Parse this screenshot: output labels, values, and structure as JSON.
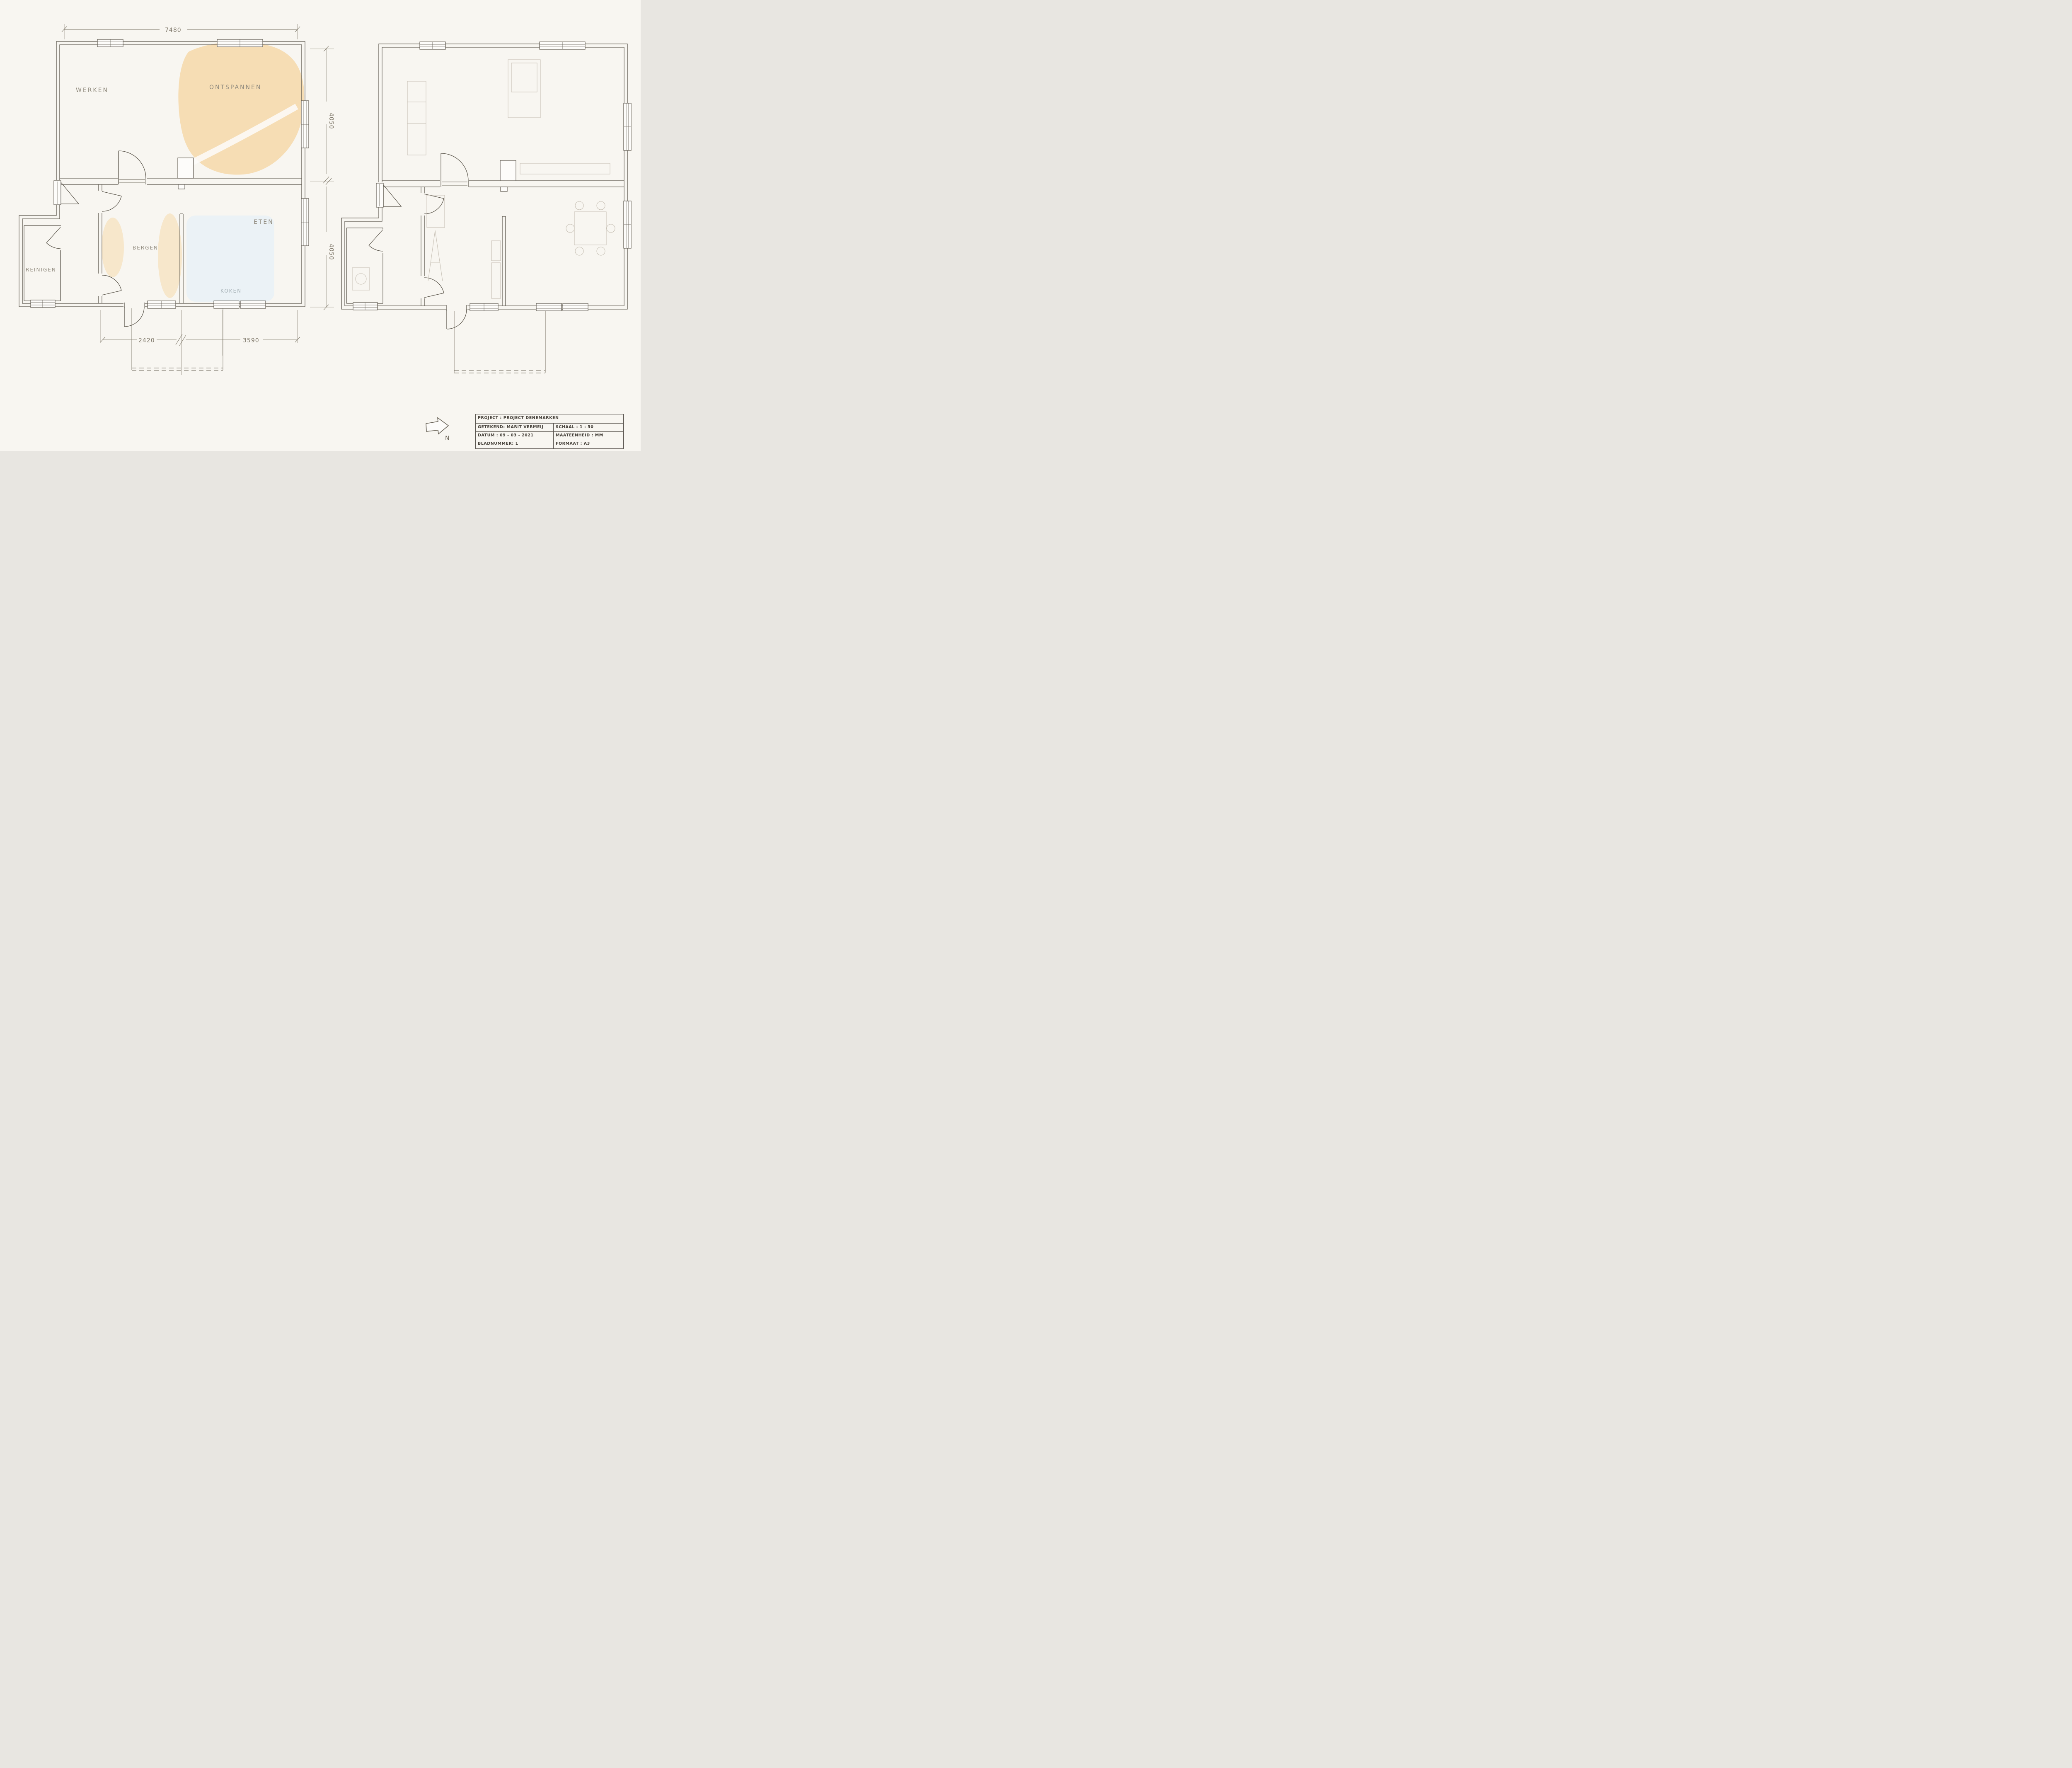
{
  "drawing": {
    "left_plan": {
      "rooms": {
        "werken": "WERKEN",
        "ontspannen": "ONTSPANNEN",
        "eten": "ETEN",
        "bergen": "BERGEN",
        "koken": "KOKEN",
        "reinigen": "REINIGEN"
      },
      "dims": {
        "top": "7480",
        "right_upper": "4050",
        "right_lower": "4050",
        "bottom_left": "2420",
        "bottom_right": "3590"
      }
    },
    "compass": {
      "north": "N"
    },
    "title_block": {
      "project": "PROJECT : PROJECT DENEMARKEN",
      "getekend": "GETEKEND: MARIT VERMEIJ",
      "schaal": "SCHAAL : 1 : 50",
      "datum": "DATUM : 09 - 03 - 2021",
      "maateenheid": "MAATEENHEID : MM",
      "bladnummer": "BLADNUMMER: 1",
      "formaat": "FORMAAT : A3"
    },
    "colors": {
      "paper": "#f8f6f1",
      "ink": "#5f5a50",
      "pencil_furniture": "#c3bdb0",
      "wash_orange": "#f5d7a6",
      "wash_blue": "#e9f2f6",
      "label_gray": "#918b7e"
    }
  }
}
